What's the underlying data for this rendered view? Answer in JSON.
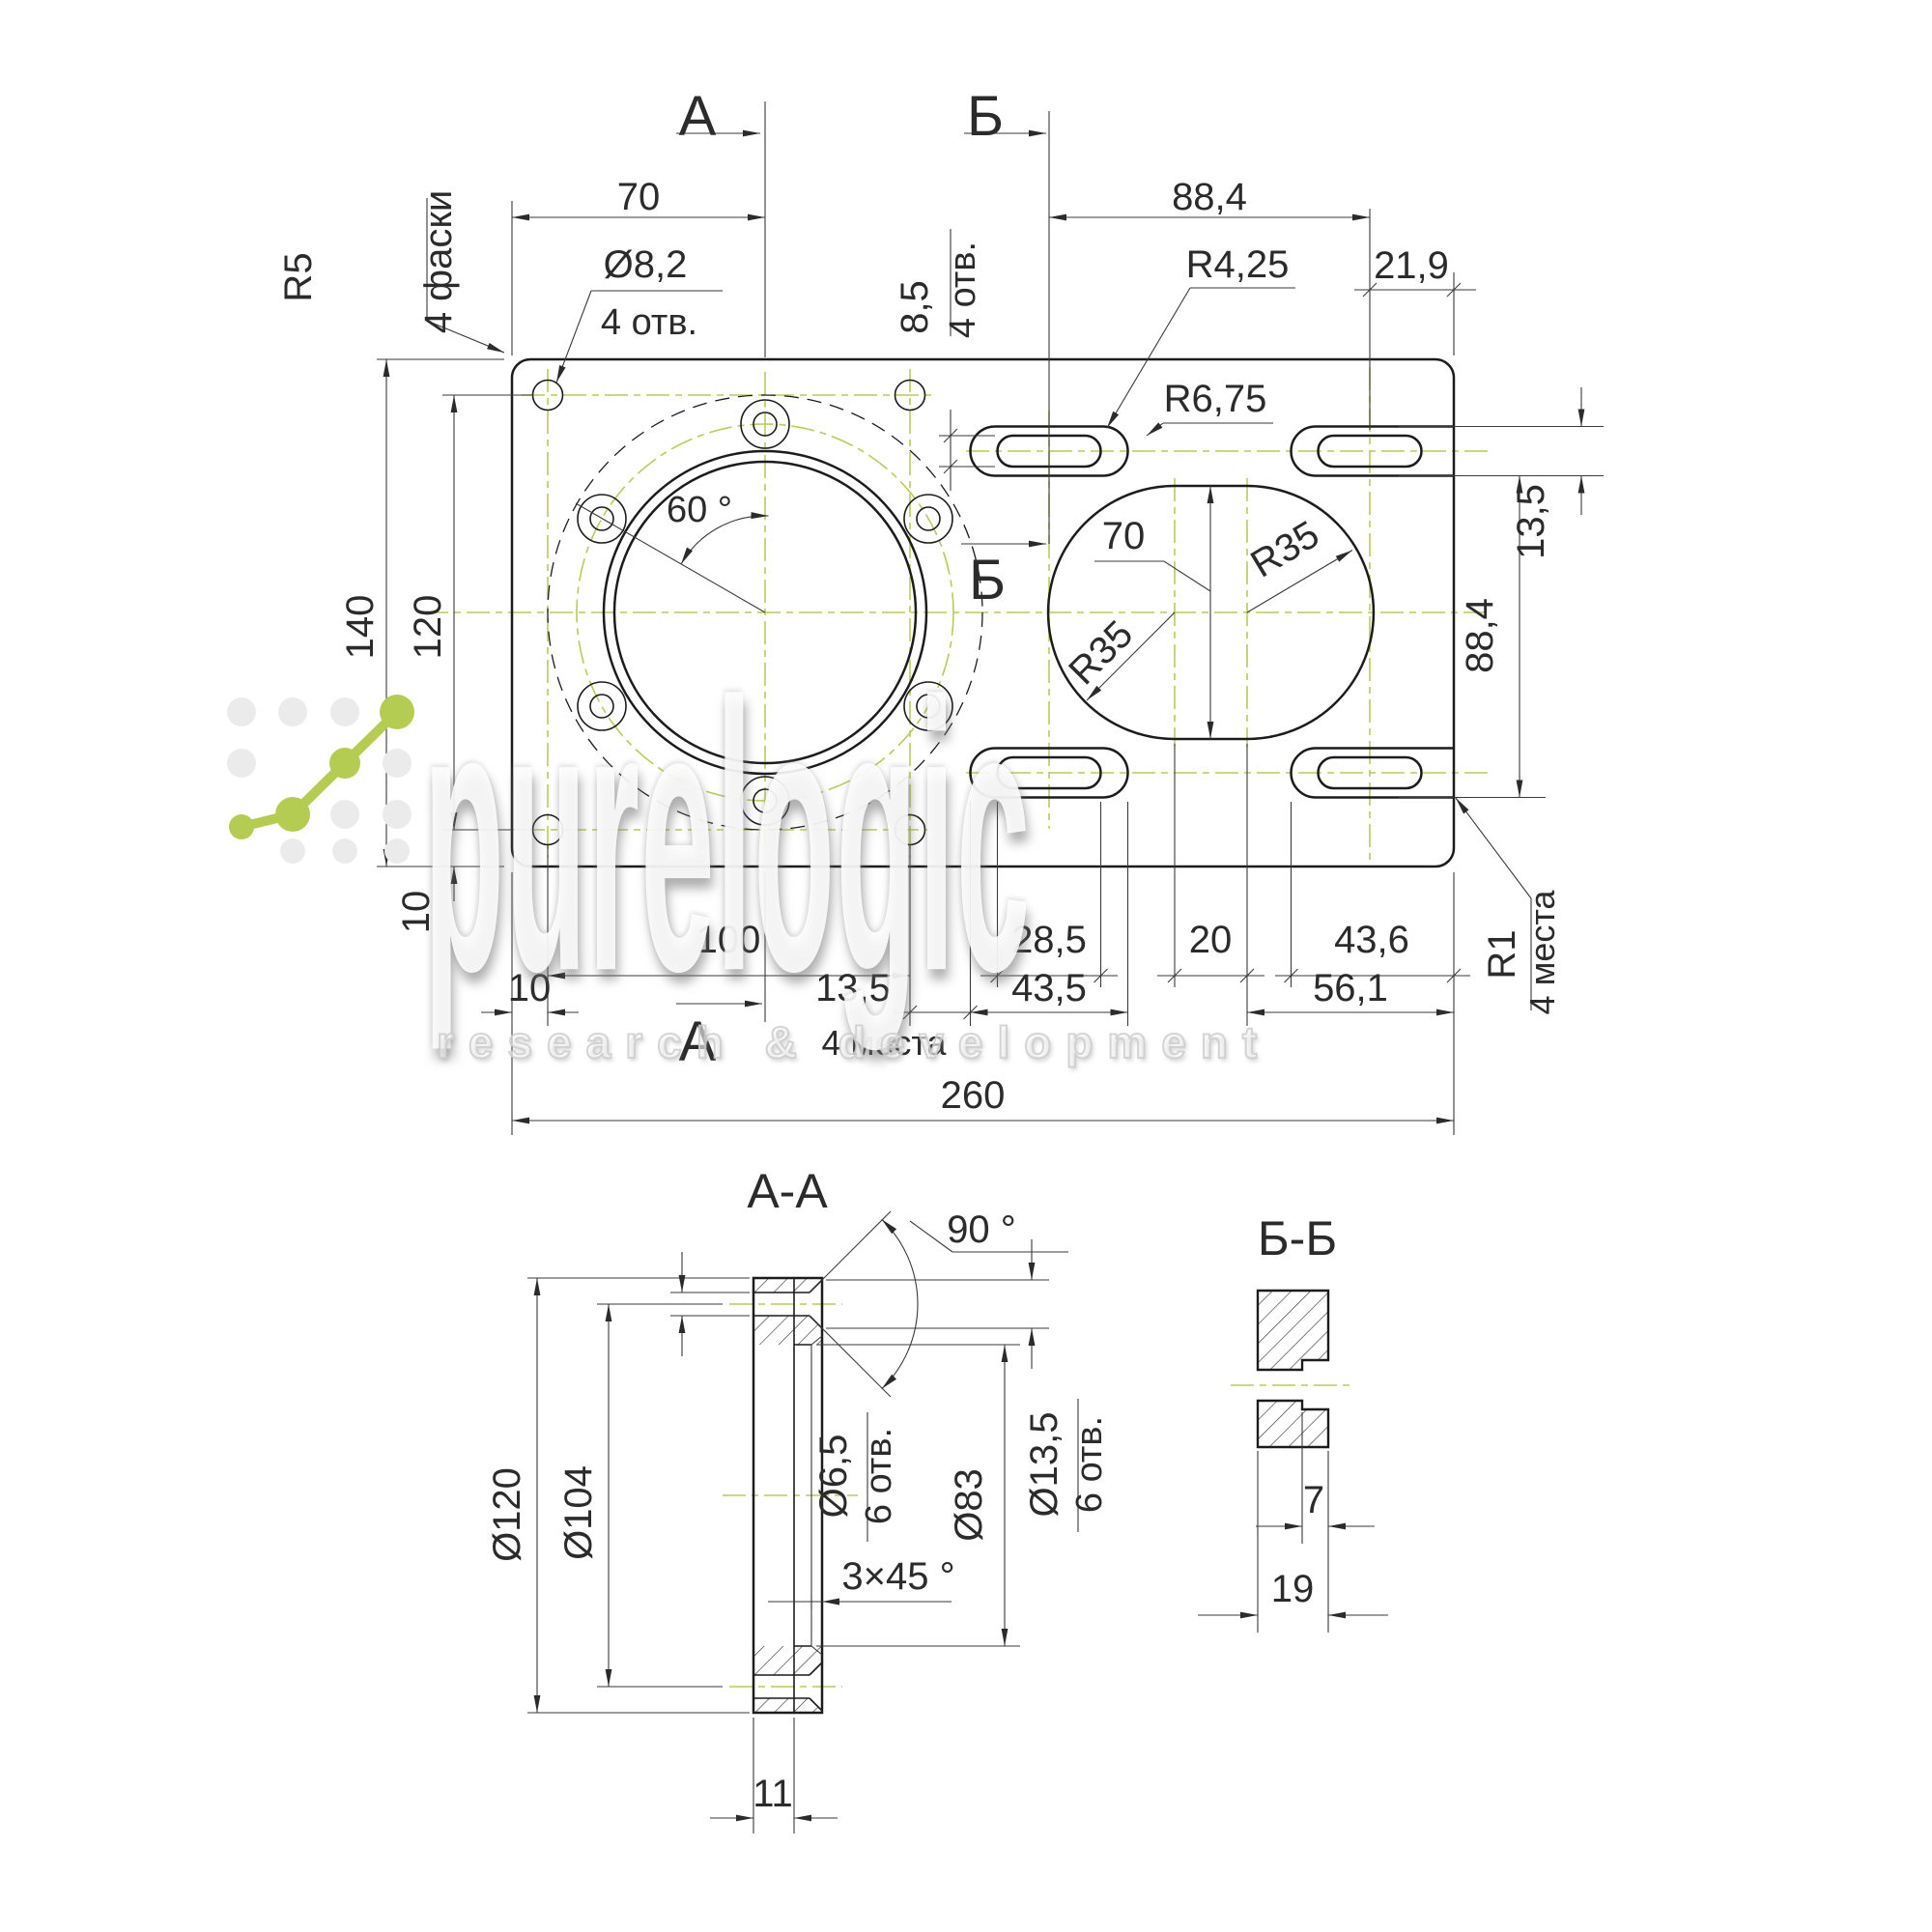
{
  "main": {
    "sections": {
      "a": "А",
      "b": "Б"
    },
    "top": {
      "w70": "70",
      "w884": "88,4",
      "w219": "21,9",
      "r5": "R5",
      "chamfers": "4 фаски",
      "d82": "Ø8,2",
      "holes4": "4 отв.",
      "slot_w": "8,5",
      "slot_holes": "4 отв.",
      "r425": "R4,25",
      "r675": "R6,75"
    },
    "left": {
      "h140": "140",
      "h120": "120",
      "v10": "10"
    },
    "center": {
      "ang60": "60 °",
      "r35": "R35",
      "v70": "70"
    },
    "right": {
      "h135": "13,5",
      "h884": "88,4",
      "r1": "R1",
      "places": "4 места"
    },
    "bottom": {
      "w10": "10",
      "w100": "100",
      "w135": "13,5",
      "w435": "43,5",
      "w285": "28,5",
      "w20": "20",
      "w436": "43,6",
      "w561": "56,1",
      "w260": "260",
      "places": "4 места"
    }
  },
  "aa": {
    "title": "А-А",
    "d120": "Ø120",
    "d104": "Ø104",
    "d65": "Ø6,5",
    "holes6": "6 отв.",
    "d135": "Ø13,5",
    "d83": "Ø83",
    "ang90": "90 °",
    "chamfer": "3×45 °",
    "t11": "11"
  },
  "bb": {
    "title": "Б-Б",
    "d7": "7",
    "d19": "19"
  },
  "watermark": {
    "brand": "purelogic",
    "tagline": "research & development"
  },
  "colors": {
    "centerline": "#bcca58",
    "outline": "#1c1c1c",
    "logo_green": "#b5cc52"
  }
}
